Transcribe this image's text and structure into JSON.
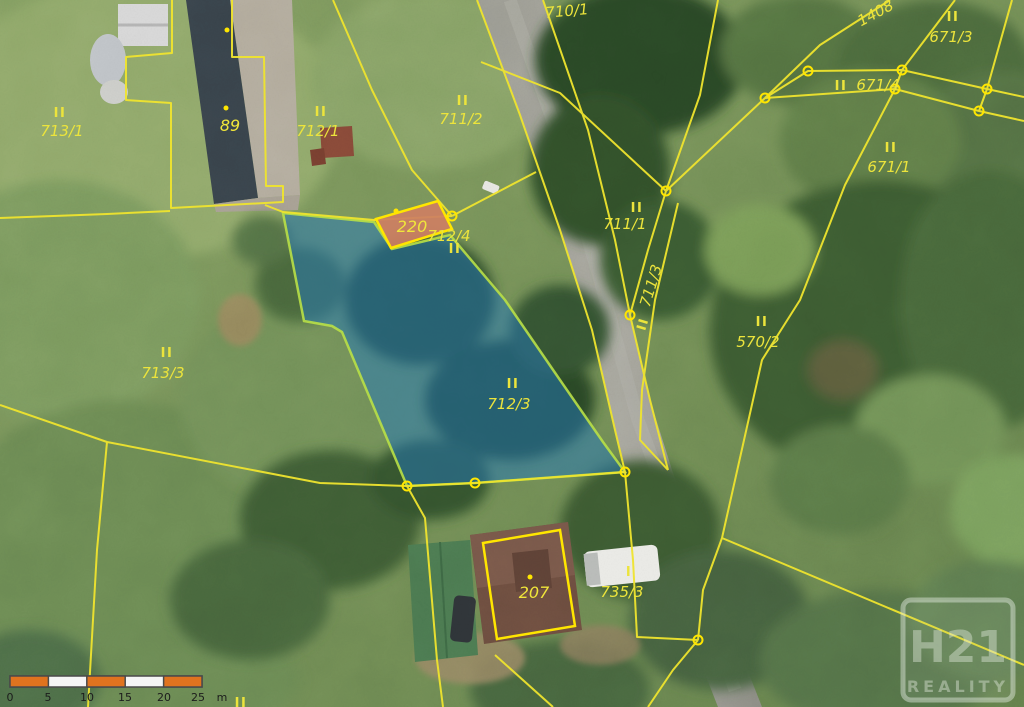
{
  "map": {
    "parcels": [
      {
        "number": "713/1",
        "mark": "II"
      },
      {
        "number": "712/1",
        "mark": "II"
      },
      {
        "number": "711/2",
        "mark": "II"
      },
      {
        "number": "710/1",
        "mark": ""
      },
      {
        "number": "1408",
        "mark": ""
      },
      {
        "number": "671/3",
        "mark": "II"
      },
      {
        "number": "671/4",
        "mark": "II"
      },
      {
        "number": "671/1",
        "mark": "II"
      },
      {
        "number": "711/1",
        "mark": "II"
      },
      {
        "number": "711/3",
        "mark": "II"
      },
      {
        "number": "570/2",
        "mark": "II"
      },
      {
        "number": "713/3",
        "mark": "II"
      },
      {
        "number": "712/3",
        "mark": "II"
      },
      {
        "number": "735/3",
        "mark": "I"
      },
      {
        "number": "712/4",
        "mark": "II"
      }
    ],
    "buildings": [
      {
        "number": "89"
      },
      {
        "number": "220"
      },
      {
        "number": "207"
      }
    ],
    "edge_mark": "II",
    "highlighted": {
      "parcel": "712/3",
      "building": "220"
    },
    "scale_bar": {
      "tick_labels": [
        "0",
        "5",
        "10",
        "15",
        "20",
        "25"
      ],
      "unit": "m"
    },
    "watermark": {
      "brand": "H21",
      "label": "REALITY"
    },
    "colors": {
      "boundary_line": "#efe42e",
      "label_text": "#ece43c",
      "selected_parcel_fill": "#2277bb",
      "selected_parcel_outline": "#b9e046",
      "highlight_building_fill": "#cd7f63",
      "highlight_outline": "#ffe600",
      "scale_bar_orange": "#e0731f"
    }
  }
}
